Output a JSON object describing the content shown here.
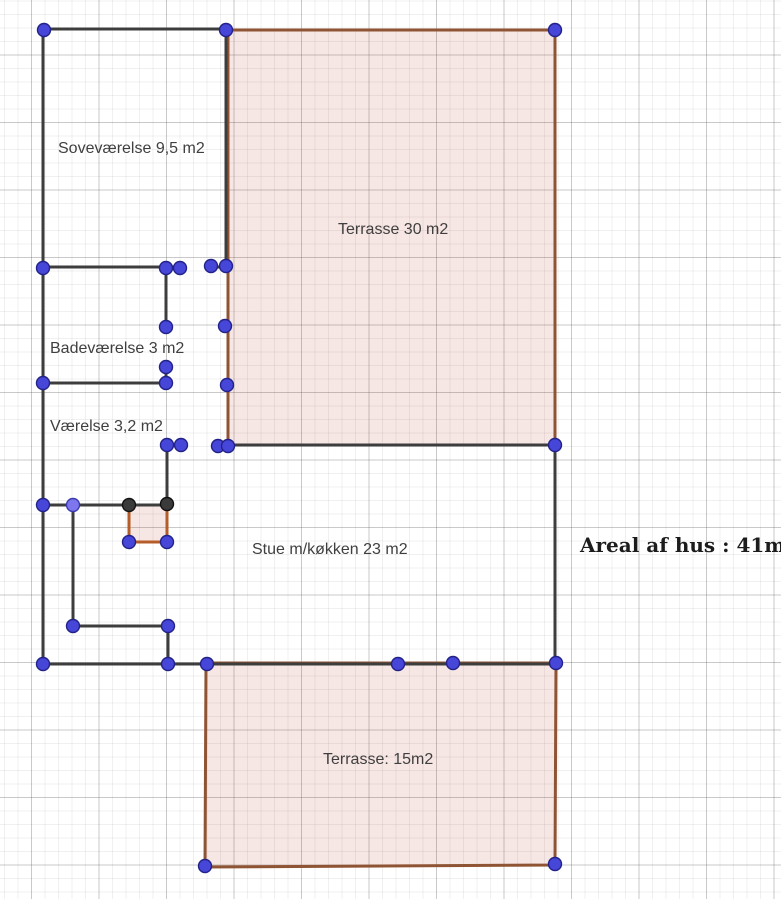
{
  "canvas": {
    "width": 781,
    "height": 899,
    "background": "#ffffff"
  },
  "grid": {
    "minor_spacing": 13.5,
    "major_spacing": 67.5,
    "offset_x": 31.5,
    "offset_y": 55,
    "minor_color": "rgba(60,60,60,0.08)",
    "major_color": "rgba(60,60,60,0.28)"
  },
  "colors": {
    "wall": "#3d3d3d",
    "terrace_stroke": "#8f5434",
    "terrace_fill": "rgba(190,60,30,0.12)",
    "square_stroke": "#b55c28",
    "point_fill": "#4646d8",
    "point_stroke": "#222288",
    "point_light_fill": "#7e76ec",
    "point_light_stroke": "#3a3ab0",
    "point_dark_fill": "#3a3a3a",
    "point_dark_stroke": "#111111",
    "label_color": "#3f3f3f",
    "areal_color": "#1c1c1c"
  },
  "polygons": [
    {
      "name": "terrasse-30-polygon",
      "stroke": "terrace_stroke",
      "width": 3,
      "points": [
        [
          228,
          30
        ],
        [
          555,
          30
        ],
        [
          555,
          445
        ],
        [
          228,
          445
        ]
      ]
    },
    {
      "name": "terrasse-15-polygon",
      "stroke": "terrace_stroke",
      "width": 3,
      "points": [
        [
          206,
          663
        ],
        [
          556,
          663
        ],
        [
          555,
          865
        ],
        [
          205,
          867
        ]
      ]
    },
    {
      "name": "fireplace-square-polygon",
      "stroke": "square_stroke",
      "width": 3,
      "points": [
        [
          129,
          505
        ],
        [
          167,
          505
        ],
        [
          167,
          542
        ],
        [
          129,
          542
        ]
      ]
    }
  ],
  "walls": [
    [
      43,
      29,
      227,
      29
    ],
    [
      43,
      29,
      43,
      665
    ],
    [
      226,
      29,
      226,
      267
    ],
    [
      43,
      267,
      181,
      267
    ],
    [
      211,
      267,
      227,
      267
    ],
    [
      166,
      267,
      166,
      327
    ],
    [
      166,
      367,
      166,
      384
    ],
    [
      43,
      383,
      166,
      383
    ],
    [
      167,
      445,
      167,
      505
    ],
    [
      167,
      445,
      181,
      445
    ],
    [
      228,
      445,
      555,
      445
    ],
    [
      555,
      445,
      555,
      664
    ],
    [
      43,
      664,
      555,
      664
    ],
    [
      73,
      505,
      73,
      626
    ],
    [
      73,
      626,
      168,
      626
    ],
    [
      168,
      626,
      168,
      664
    ],
    [
      43,
      505,
      129,
      505
    ],
    [
      129,
      505,
      167,
      505
    ]
  ],
  "points": [
    {
      "x": 44,
      "y": 30,
      "variant": "blue"
    },
    {
      "x": 226,
      "y": 30,
      "variant": "blue"
    },
    {
      "x": 555,
      "y": 30,
      "variant": "blue"
    },
    {
      "x": 43,
      "y": 268,
      "variant": "blue"
    },
    {
      "x": 166,
      "y": 268,
      "variant": "blue"
    },
    {
      "x": 180,
      "y": 268,
      "variant": "blue"
    },
    {
      "x": 211,
      "y": 266,
      "variant": "blue"
    },
    {
      "x": 226,
      "y": 266,
      "variant": "blue"
    },
    {
      "x": 166,
      "y": 327,
      "variant": "blue"
    },
    {
      "x": 225,
      "y": 326,
      "variant": "blue"
    },
    {
      "x": 166,
      "y": 367,
      "variant": "blue"
    },
    {
      "x": 43,
      "y": 383,
      "variant": "blue"
    },
    {
      "x": 166,
      "y": 383,
      "variant": "blue"
    },
    {
      "x": 227,
      "y": 385,
      "variant": "blue"
    },
    {
      "x": 167,
      "y": 445,
      "variant": "blue"
    },
    {
      "x": 181,
      "y": 445,
      "variant": "blue"
    },
    {
      "x": 218,
      "y": 446,
      "variant": "blue"
    },
    {
      "x": 228,
      "y": 446,
      "variant": "blue"
    },
    {
      "x": 555,
      "y": 445,
      "variant": "blue"
    },
    {
      "x": 43,
      "y": 505,
      "variant": "blue"
    },
    {
      "x": 73,
      "y": 505,
      "variant": "light"
    },
    {
      "x": 129,
      "y": 505,
      "variant": "dark"
    },
    {
      "x": 167,
      "y": 504,
      "variant": "dark"
    },
    {
      "x": 129,
      "y": 542,
      "variant": "blue"
    },
    {
      "x": 167,
      "y": 542,
      "variant": "blue"
    },
    {
      "x": 73,
      "y": 626,
      "variant": "blue"
    },
    {
      "x": 168,
      "y": 626,
      "variant": "blue"
    },
    {
      "x": 43,
      "y": 664,
      "variant": "blue"
    },
    {
      "x": 168,
      "y": 664,
      "variant": "blue"
    },
    {
      "x": 207,
      "y": 664,
      "variant": "blue"
    },
    {
      "x": 398,
      "y": 664,
      "variant": "blue"
    },
    {
      "x": 453,
      "y": 663,
      "variant": "blue"
    },
    {
      "x": 556,
      "y": 663,
      "variant": "blue"
    },
    {
      "x": 205,
      "y": 866,
      "variant": "blue"
    },
    {
      "x": 555,
      "y": 864,
      "variant": "blue"
    }
  ],
  "labels": [
    {
      "name": "label-sovevaerelse",
      "text": "Soveværelse 9,5 m2",
      "x": 58,
      "y": 153,
      "size": 16,
      "style": "room"
    },
    {
      "name": "label-terrasse-30",
      "text": "Terrasse 30 m2",
      "x": 338,
      "y": 234,
      "size": 16,
      "style": "room"
    },
    {
      "name": "label-badevaerelse",
      "text": "Badeværelse 3 m2",
      "x": 50,
      "y": 353,
      "size": 16,
      "style": "room"
    },
    {
      "name": "label-vaerelse",
      "text": "Værelse 3,2 m2",
      "x": 50,
      "y": 431,
      "size": 16,
      "style": "room"
    },
    {
      "name": "label-stue",
      "text": "Stue m/køkken 23 m2",
      "x": 252,
      "y": 554,
      "size": 16,
      "style": "room"
    },
    {
      "name": "label-terrasse-15",
      "text": "Terrasse: 15m2",
      "x": 323,
      "y": 764,
      "size": 16,
      "style": "room"
    },
    {
      "name": "label-areal-af-hus",
      "text": "Areal af hus : 41m2",
      "x": 580,
      "y": 552,
      "size": 20,
      "style": "areal"
    }
  ]
}
